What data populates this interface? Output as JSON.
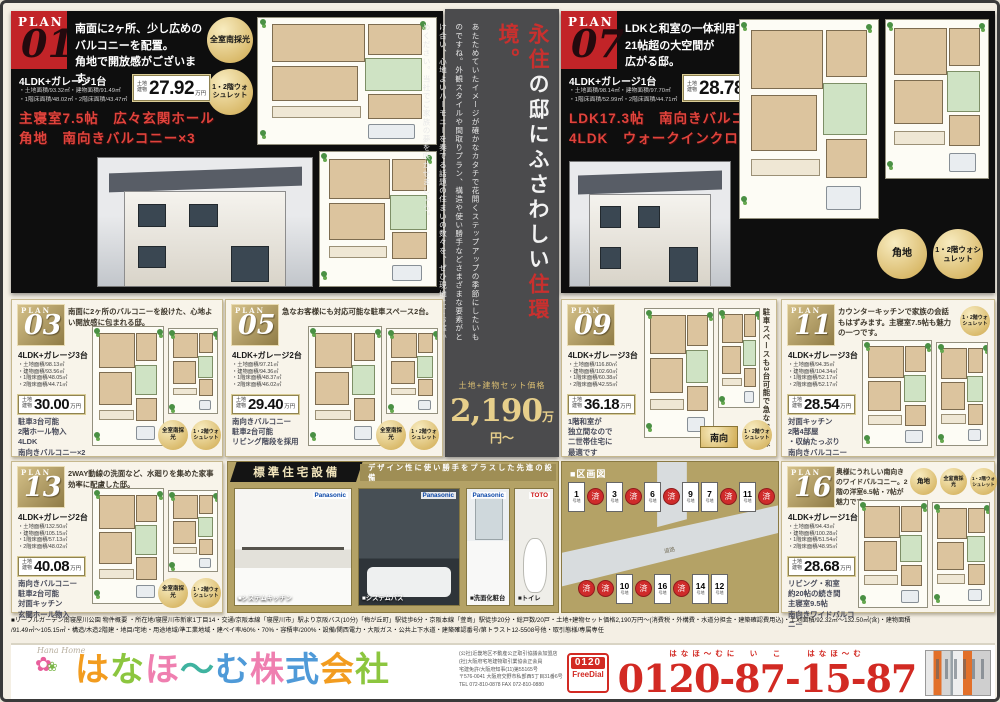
{
  "plan01": {
    "plan_word": "PLAN",
    "id": "01",
    "catch": [
      "南面に2ヶ所、少し広めの",
      "バルコニーを配置。",
      "角地で開放感がございます。"
    ],
    "spec": "4LDK+ガレージ1台",
    "areas": [
      "・土地面積/93.32㎡・建物面積/91.49㎡",
      "・1階床面積/48.02㎡・2階床面積/43.47㎡"
    ],
    "price": {
      "prefix": [
        "土地",
        "建物"
      ],
      "value": "27.92",
      "suffix": "万円"
    },
    "features": [
      "主寝室7.5帖　広々玄関ホール",
      "角地　南向きバルコニー×3"
    ],
    "badges": [
      "全室南採光",
      "1・2階ウォシュレット"
    ]
  },
  "plan07": {
    "plan_word": "PLAN",
    "id": "07",
    "catch": [
      "LDKと和室の一体利用で、",
      "21帖超の大空間が",
      "広がる邸。"
    ],
    "spec": "4LDK+ガレージ1台",
    "areas": [
      "・土地面積/98.14㎡・建物面積/97.70㎡",
      "・1階床面積/52.99㎡・2階床面積/44.71㎡"
    ],
    "price": {
      "prefix": [
        "土地",
        "建物"
      ],
      "value": "28.78",
      "suffix": "万円"
    },
    "features": [
      "LDK17.3帖　南向きバルコニー",
      "4LDK　ウォークインクローゼット"
    ],
    "badges": [
      "角地",
      "1・2階ウォシュレット"
    ]
  },
  "center": {
    "h1": "永住",
    "h2": "の邸にふさわしい",
    "h3": "住環境。",
    "body": "あたためていたイメージが確かなカタチで花開くステップアップの季節にしたいものですね。外観スタイルや間取りプラン、構造や使い勝手などさまざまな要素がとけ合い、心地よいハーモニーを奏でる話題の住まいの数々を、ぜひ現地にてお確かめください。当社でご家族の夢を咲かせましょう。",
    "price_label": "土地+建物セット価格",
    "price_value": "2,190",
    "price_suffix": "万円〜"
  },
  "plans": [
    {
      "plan_word": "PLAN",
      "id": "03",
      "catch": "南面に2ヶ所のバルコニーを設けた、心地よい開放感に包まれる邸。",
      "spec": "4LDK+ガレージ3台",
      "areas": [
        "・土地面積/98.13㎡",
        "・建物面積/93.56㎡",
        "・1階床面積/48.05㎡",
        "・2階床面積/44.71㎡"
      ],
      "price": {
        "prefix": [
          "土地",
          "建物"
        ],
        "value": "30.00",
        "suffix": "万円"
      },
      "features": [
        "駐車3台可能",
        "2階ホール物入",
        "4LDK",
        "南向きバルコニー×2"
      ],
      "badges": [
        "全室南採光",
        "1・2階ウォシュレット"
      ]
    },
    {
      "plan_word": "PLAN",
      "id": "05",
      "catch": "急なお客様にも対応可能な駐車スペース2台。",
      "spec": "4LDK+ガレージ2台",
      "areas": [
        "・土地面積/97.21㎡",
        "・建物面積/94.36㎡",
        "・1階床面積/48.37㎡",
        "・2階床面積/46.02㎡"
      ],
      "price": {
        "prefix": [
          "土地",
          "建物"
        ],
        "value": "29.40",
        "suffix": "万円"
      },
      "features": [
        "南向きバルコニー",
        "駐車2台可能",
        "リビング階段を採用"
      ],
      "badges": [
        "全室南採光",
        "1・2階ウォシュレット"
      ]
    },
    {
      "plan_word": "PLAN",
      "id": "09",
      "catch": "駐車スペースも3台可能で急なお客様にも対応できます。",
      "spec": "4LDK+ガレージ3台",
      "areas": [
        "・土地面積/116.80㎡",
        "・建物面積/102.60㎡",
        "・1階床面積/60.38㎡",
        "・2階床面積/42.55㎡"
      ],
      "price": {
        "prefix": [
          "土地",
          "建物"
        ],
        "value": "36.18",
        "suffix": "万円"
      },
      "features": [
        "1階和室が",
        "独立間なので",
        "二世帯住宅に",
        "最適です"
      ],
      "badges": [
        "南向",
        "1・2階ウォシュレット"
      ]
    },
    {
      "plan_word": "PLAN",
      "id": "11",
      "catch": "カウンターキッチンで家族の会話もはずみます。主寝室7.5帖も魅力の一つです。",
      "spec": "4LDK+ガレージ3台",
      "areas": [
        "・土地面積/94.35㎡",
        "・建物面積/104.34㎡",
        "・1階床面積/52.17㎡",
        "・2階床面積/52.17㎡"
      ],
      "price": {
        "prefix": [
          "土地",
          "建物"
        ],
        "value": "28.54",
        "suffix": "万円"
      },
      "features": [
        "対面キッチン",
        "2階4部屋",
        "・収納たっぷり",
        "南向きバルコニー"
      ],
      "badges": [
        "1・2階ウォシュレット"
      ]
    },
    {
      "plan_word": "PLAN",
      "id": "13",
      "catch": "2WAY動線の洗面など、水廻りを集めた家事効率に配慮した邸。",
      "spec": "4LDK+ガレージ2台",
      "areas": [
        "・土地面積/132.50㎡",
        "・建物面積/105.15㎡",
        "・1階床面積/57.13㎡",
        "・2階床面積/48.02㎡"
      ],
      "price": {
        "prefix": [
          "土地",
          "建物"
        ],
        "value": "40.08",
        "suffix": "万円"
      },
      "features": [
        "南向きバルコニー",
        "駐車2台可能",
        "対面キッチン",
        "玄関ホール物入"
      ],
      "badges": [
        "全室南採光",
        "1・2階ウォシュレット"
      ]
    },
    {
      "plan_word": "PLAN",
      "id": "16",
      "catch": "奥様にうれしい南向きのワイドバルコニー。2階の洋室6.5帖・7帖が魅力です。",
      "spec": "4LDK+ガレージ1台",
      "areas": [
        "・土地面積/94.43㎡",
        "・建物面積/100.28㎡",
        "・1階床面積/51.54㎡",
        "・2階床面積/48.95㎡"
      ],
      "price": {
        "prefix": [
          "土地",
          "建物"
        ],
        "value": "28.68",
        "suffix": "万円"
      },
      "features": [
        "リビング・和室",
        "約20帖の続き間",
        "主寝室9.5帖",
        "南向きワイドバルコニー"
      ],
      "badges": [
        "角地",
        "全室南採光",
        "1・2階ウォシュレット"
      ]
    }
  ],
  "equipment": {
    "title": "標準住宅設備",
    "subtitle": "デザイン性に使い勝手をプラスした先進の設備",
    "items": [
      {
        "brand": "Panasonic",
        "caption": "■システムキッチン"
      },
      {
        "brand": "Panasonic",
        "caption": "■システムバス"
      },
      {
        "brand": "Panasonic",
        "caption": "■洗面化粧台"
      },
      {
        "brand": "TOTO",
        "caption": "■トイレ"
      }
    ]
  },
  "siteplan": {
    "label": "■区画図",
    "road_label": "道路",
    "unit": "号地",
    "rows": [
      [
        {
          "t": "1"
        },
        {
          "t": "済",
          "sold": true
        },
        {
          "t": "3"
        },
        {
          "t": "済",
          "sold": true
        },
        {
          "t": "6"
        },
        {
          "t": "済",
          "sold": true
        },
        {
          "t": "9"
        },
        {
          "t": "7"
        },
        {
          "t": "済",
          "sold": true
        },
        {
          "t": "11"
        },
        {
          "t": "済",
          "sold": true
        }
      ],
      [
        {
          "t": "済",
          "sold": true
        },
        {
          "t": "済",
          "sold": true
        },
        {
          "t": "10"
        },
        {
          "t": "済",
          "sold": true
        },
        {
          "t": "16"
        },
        {
          "t": "済",
          "sold": true
        },
        {
          "t": "14"
        },
        {
          "t": "12"
        }
      ]
    ]
  },
  "disclaimer": {
    "line1": "■リーブルガーデン南寝屋川公園 物件概要 ・所在地/寝屋川市新家1丁目14・交通/京阪本線「寝屋川市」駅より京阪バス(10分)「梅が丘町」駅徒歩6分・京阪本線「萱島」駅徒歩20分・総戸数/20戸・土地+建物セット価格2,190万円〜(消費税・外構費・水道分担金・建築確認費用込)・土地面積/92.32㎡〜132.50㎡(含)・建物面積",
    "line2": "/91.49㎡〜105.15㎡・構造/木造2階建・地目/宅地・用途地域/準工業地域・建ペイ率/60%・70%・容積率/200%・設備/関西電力・大阪ガス・公共上下水道・建築確認番号/第トラスト12-5508号他・取引態様/専属専任"
  },
  "footer": {
    "script_logo": "Hana Home",
    "company": "はなほ〜む株式会社",
    "company_chars": [
      {
        "c": "は",
        "color": "#f29c1f"
      },
      {
        "c": "な",
        "color": "#8cc63f"
      },
      {
        "c": "ほ",
        "color": "#ef7fb0"
      },
      {
        "c": "〜",
        "color": "#3fb3a0"
      },
      {
        "c": "む",
        "color": "#4f9ad8"
      },
      {
        "c": "株",
        "color": "#ef7fb0"
      },
      {
        "c": "式",
        "color": "#4f9ad8"
      },
      {
        "c": "会",
        "color": "#f29c1f"
      },
      {
        "c": "社",
        "color": "#8cc63f"
      }
    ],
    "legal": [
      "(公社)近畿地区不動産公正取引協議会加盟店",
      "(社)大阪府宅地建物取引業協会正会員",
      "宅建免許/大阪府知事(11)第55165号"
    ],
    "address": [
      "〒576-0041 大阪府交野市私部西5丁目31番6号",
      "TEL 072-810-0878 FAX 072-810-0880"
    ],
    "freedial_top": "0120",
    "freedial_bottom": "FreeDial",
    "phone_ruby": "はなほ〜むに　い　こ　　はなほ〜む",
    "phone": "0120-87-15-87"
  }
}
